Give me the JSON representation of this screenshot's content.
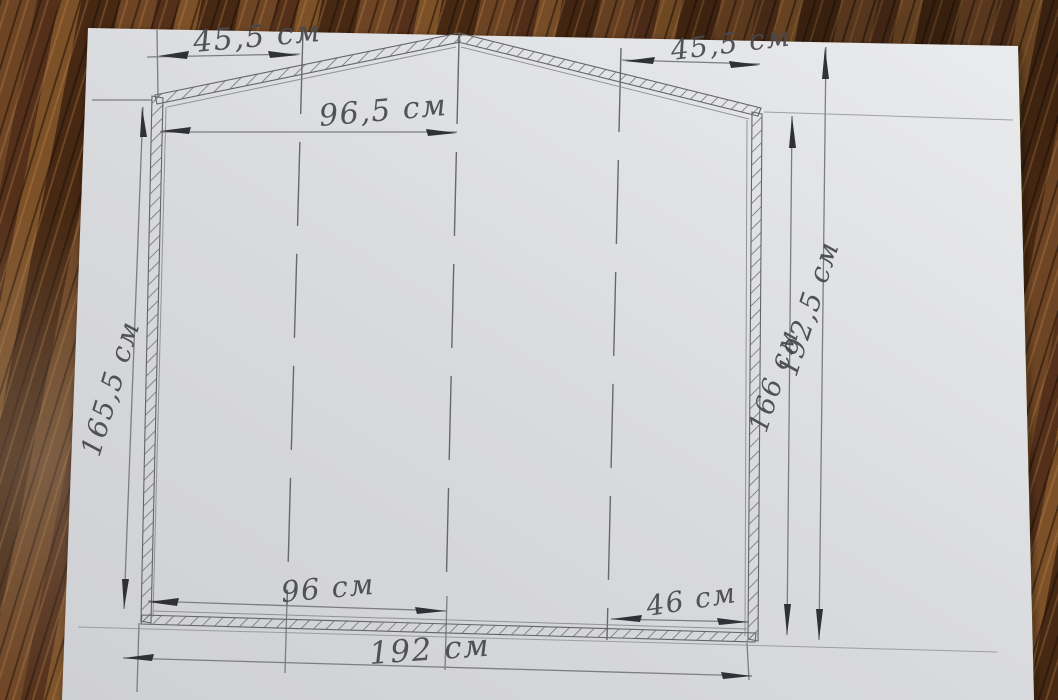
{
  "diagram": {
    "dimensions": {
      "top_left_roof": "45,5 см",
      "top_right_roof": "45,5 см",
      "ridge_to_left_wall": "96,5 см",
      "left_wall_height": "165,5 см",
      "right_wall_height": "166 см",
      "overall_height": "192,5 см",
      "bottom_left_half": "96 см",
      "bottom_right_segment": "46 см",
      "overall_width": "192 см"
    }
  },
  "colors": {
    "paper": "#d9dadd",
    "pencil_line": "#7c7d81",
    "pencil_arrow": "#303136",
    "handwriting": "#47484d",
    "wood_dark": "#472812",
    "wood_mid": "#6e4524",
    "wood_light": "#9c6b38"
  }
}
